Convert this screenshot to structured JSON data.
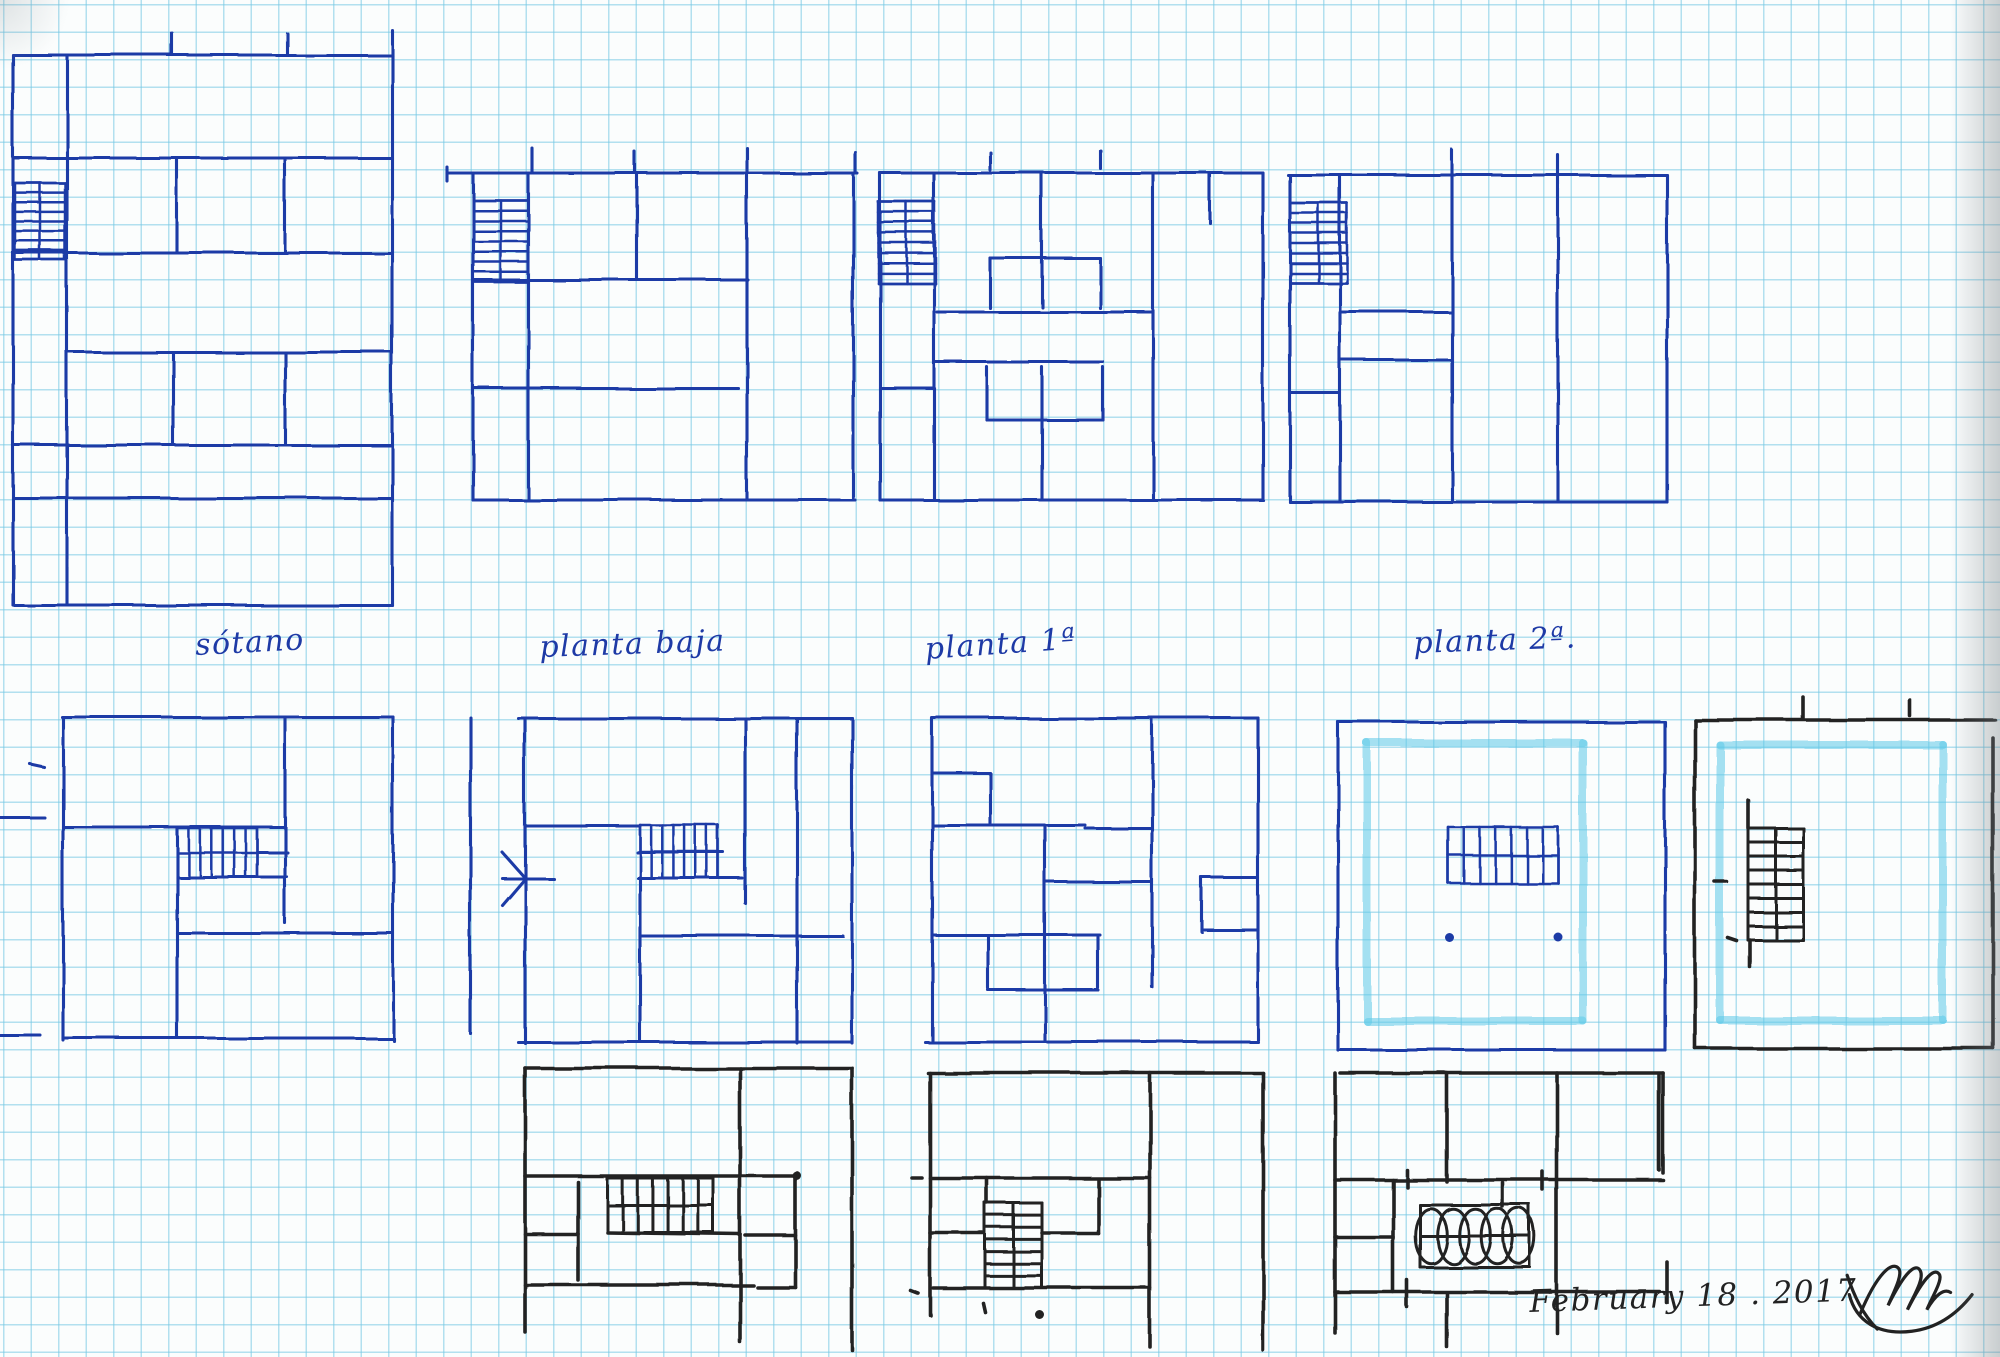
{
  "page": {
    "description": "Hand-drawn architectural floor plan sketches in ink on squared graph paper"
  },
  "colors": {
    "blue": "#1e3aa6",
    "black": "#222222",
    "highlighter": "#5cc9e8",
    "grid": "#76c8e4",
    "paper": "#fbfdfd"
  },
  "labels": [
    {
      "id": "sotano",
      "text": "sótano",
      "x": 196,
      "y": 628,
      "size": 30,
      "ink": "blue",
      "rot": -3
    },
    {
      "id": "planta-baja",
      "text": "planta baja",
      "x": 540,
      "y": 630,
      "size": 30,
      "ink": "blue",
      "rot": -2
    },
    {
      "id": "planta-1",
      "text": "planta 1ª",
      "x": 926,
      "y": 632,
      "size": 30,
      "ink": "blue",
      "rot": -4
    },
    {
      "id": "planta-2",
      "text": "planta 2ª.",
      "x": 1414,
      "y": 626,
      "size": 30,
      "ink": "blue",
      "rot": -2
    },
    {
      "id": "date-note",
      "text": "February 18 . 2017",
      "x": 1530,
      "y": 1284,
      "size": 31,
      "ink": "black",
      "rot": -2
    }
  ],
  "signature": {
    "strokes": [
      "M2,22 C8,40 16,58 30,72",
      "M14,58 C30,20 44,8 50,16 C54,22 44,40 40,50 C56,18 66,10 70,18 C74,26 62,44 58,54 C74,22 84,14 88,22 C90,28 80,44 76,54 C84,40 92,34 98,38",
      "M4,40 C10,64 30,78 62,74 C86,71 104,58 118,40"
    ]
  },
  "plans": [
    {
      "id": "sotano-upper",
      "ink": "blue",
      "lines": [
        [
          13,
          55,
          392,
          55
        ],
        [
          13,
          55,
          13,
          605
        ],
        [
          392,
          55,
          392,
          605
        ],
        [
          13,
          605,
          392,
          605
        ],
        [
          67,
          55,
          67,
          605
        ],
        [
          13,
          158,
          392,
          158
        ],
        [
          13,
          253,
          392,
          253
        ],
        [
          67,
          352,
          392,
          352
        ],
        [
          13,
          445,
          392,
          445
        ],
        [
          13,
          498,
          392,
          498
        ],
        [
          177,
          158,
          177,
          253
        ],
        [
          285,
          158,
          285,
          253
        ],
        [
          173,
          352,
          173,
          443
        ],
        [
          285,
          352,
          285,
          443
        ],
        [
          172,
          33,
          172,
          55
        ],
        [
          287,
          33,
          287,
          55
        ],
        [
          392,
          30,
          392,
          55
        ]
      ],
      "stairs": [
        {
          "x": 15,
          "y": 183,
          "w": 50,
          "h": 77,
          "dir": "h",
          "steps": 9,
          "center": true,
          "border": true
        }
      ],
      "dots": []
    },
    {
      "id": "planta-baja-upper",
      "ink": "blue",
      "lines": [
        [
          447,
          173,
          857,
          173
        ],
        [
          447,
          167,
          447,
          181
        ],
        [
          473,
          173,
          473,
          500
        ],
        [
          528,
          173,
          528,
          500
        ],
        [
          637,
          173,
          637,
          278
        ],
        [
          473,
          280,
          748,
          280
        ],
        [
          747,
          173,
          747,
          500
        ],
        [
          473,
          388,
          738,
          388
        ],
        [
          853,
          173,
          853,
          500
        ],
        [
          473,
          500,
          855,
          500
        ],
        [
          532,
          148,
          532,
          173
        ],
        [
          635,
          152,
          635,
          173
        ],
        [
          747,
          148,
          747,
          173
        ],
        [
          855,
          152,
          855,
          173
        ]
      ],
      "stairs": [
        {
          "x": 473,
          "y": 200,
          "w": 55,
          "h": 82,
          "dir": "h",
          "steps": 9,
          "center": true,
          "border": true
        }
      ],
      "dots": []
    },
    {
      "id": "planta-1-upper",
      "ink": "blue",
      "lines": [
        [
          880,
          173,
          1263,
          173
        ],
        [
          880,
          173,
          880,
          500
        ],
        [
          934,
          173,
          934,
          500
        ],
        [
          1042,
          173,
          1042,
          307
        ],
        [
          990,
          258,
          1100,
          258
        ],
        [
          990,
          258,
          990,
          308
        ],
        [
          1100,
          258,
          1100,
          308
        ],
        [
          937,
          312,
          1153,
          312
        ],
        [
          1153,
          173,
          1153,
          500
        ],
        [
          935,
          362,
          1103,
          362
        ],
        [
          987,
          367,
          987,
          420
        ],
        [
          1103,
          367,
          1103,
          420
        ],
        [
          987,
          420,
          1103,
          420
        ],
        [
          1042,
          367,
          1042,
          500
        ],
        [
          880,
          388,
          934,
          388
        ],
        [
          1263,
          173,
          1263,
          500
        ],
        [
          880,
          500,
          1263,
          500
        ],
        [
          1210,
          173,
          1210,
          223
        ],
        [
          990,
          152,
          990,
          170
        ],
        [
          1100,
          150,
          1100,
          168
        ]
      ],
      "stairs": [
        {
          "x": 878,
          "y": 202,
          "w": 57,
          "h": 81,
          "dir": "h",
          "steps": 9,
          "center": true,
          "border": true
        }
      ],
      "dots": []
    },
    {
      "id": "planta-2-upper",
      "ink": "blue",
      "lines": [
        [
          1288,
          175,
          1667,
          175
        ],
        [
          1290,
          175,
          1290,
          502
        ],
        [
          1340,
          175,
          1340,
          502
        ],
        [
          1452,
          175,
          1452,
          502
        ],
        [
          1340,
          312,
          1452,
          312
        ],
        [
          1340,
          360,
          1452,
          360
        ],
        [
          1290,
          393,
          1340,
          393
        ],
        [
          1558,
          175,
          1558,
          502
        ],
        [
          1667,
          175,
          1667,
          502
        ],
        [
          1290,
          502,
          1667,
          502
        ],
        [
          1452,
          150,
          1452,
          175
        ],
        [
          1558,
          155,
          1558,
          175
        ]
      ],
      "stairs": [
        {
          "x": 1290,
          "y": 203,
          "w": 57,
          "h": 80,
          "dir": "h",
          "steps": 9,
          "center": true,
          "border": true
        }
      ],
      "dots": []
    },
    {
      "id": "sotano-lower",
      "ink": "blue",
      "lines": [
        [
          62,
          717,
          393,
          717
        ],
        [
          63,
          717,
          63,
          1040
        ],
        [
          393,
          717,
          393,
          1040
        ],
        [
          63,
          1038,
          393,
          1038
        ],
        [
          285,
          717,
          285,
          923
        ],
        [
          63,
          827,
          285,
          827
        ],
        [
          177,
          828,
          177,
          1038
        ],
        [
          177,
          933,
          393,
          933
        ],
        [
          257,
          852,
          287,
          852
        ],
        [
          177,
          877,
          287,
          877
        ],
        [
          0,
          818,
          45,
          818
        ],
        [
          0,
          1035,
          40,
          1035
        ],
        [
          30,
          764,
          44,
          767
        ]
      ],
      "stairs": [
        {
          "x": 177,
          "y": 828,
          "w": 80,
          "h": 49,
          "dir": "v",
          "steps": 8,
          "center": true,
          "border": true
        }
      ],
      "dots": []
    },
    {
      "id": "planta-baja-lower",
      "ink": "blue",
      "lines": [
        [
          470,
          717,
          470,
          1033
        ],
        [
          518,
          718,
          852,
          718
        ],
        [
          525,
          718,
          525,
          1043
        ],
        [
          502,
          852,
          525,
          878
        ],
        [
          502,
          905,
          525,
          878
        ],
        [
          502,
          878,
          553,
          878
        ],
        [
          525,
          826,
          640,
          826
        ],
        [
          637,
          852,
          723,
          852
        ],
        [
          638,
          878,
          742,
          878
        ],
        [
          745,
          718,
          745,
          903
        ],
        [
          640,
          878,
          640,
          1040
        ],
        [
          640,
          936,
          843,
          936
        ],
        [
          797,
          718,
          797,
          1043
        ],
        [
          852,
          718,
          852,
          1043
        ],
        [
          518,
          1042,
          852,
          1042
        ]
      ],
      "stairs": [
        {
          "x": 640,
          "y": 825,
          "w": 78,
          "h": 53,
          "dir": "v",
          "steps": 8,
          "center": true,
          "border": true
        }
      ],
      "dots": []
    },
    {
      "id": "planta-1-lower",
      "ink": "blue",
      "lines": [
        [
          933,
          718,
          1258,
          718
        ],
        [
          932,
          718,
          932,
          1040
        ],
        [
          932,
          773,
          990,
          773
        ],
        [
          990,
          773,
          990,
          823
        ],
        [
          932,
          825,
          1085,
          825
        ],
        [
          1085,
          828,
          1150,
          828
        ],
        [
          1045,
          825,
          1045,
          1040
        ],
        [
          1152,
          718,
          1152,
          987
        ],
        [
          1045,
          882,
          1152,
          882
        ],
        [
          1202,
          878,
          1258,
          878
        ],
        [
          1202,
          878,
          1202,
          932
        ],
        [
          1202,
          930,
          1258,
          930
        ],
        [
          932,
          935,
          1100,
          935
        ],
        [
          988,
          937,
          988,
          988
        ],
        [
          1098,
          937,
          1098,
          988
        ],
        [
          988,
          990,
          1098,
          990
        ],
        [
          925,
          1042,
          1258,
          1042
        ],
        [
          1258,
          718,
          1258,
          1040
        ]
      ],
      "stairs": [],
      "dots": []
    },
    {
      "id": "planta-2-lower",
      "ink": "blue",
      "highlight": {
        "x": 1367,
        "y": 743,
        "w": 216,
        "h": 278
      },
      "lines": [
        [
          1338,
          722,
          1665,
          722
        ],
        [
          1338,
          722,
          1338,
          1050
        ],
        [
          1665,
          722,
          1665,
          1050
        ],
        [
          1338,
          1050,
          1665,
          1050
        ]
      ],
      "stairs": [
        {
          "x": 1448,
          "y": 827,
          "w": 110,
          "h": 56,
          "dir": "v",
          "steps": 8,
          "center": true,
          "border": true
        }
      ],
      "dots": [
        [
          1450,
          938
        ],
        [
          1558,
          937
        ]
      ]
    },
    {
      "id": "roof-plan",
      "ink": "black",
      "highlight": {
        "x": 1720,
        "y": 745,
        "w": 223,
        "h": 275
      },
      "lines": [
        [
          1695,
          720,
          1995,
          720
        ],
        [
          1695,
          720,
          1695,
          1048
        ],
        [
          1993,
          738,
          1993,
          1048
        ],
        [
          1695,
          1048,
          1993,
          1048
        ],
        [
          1748,
          800,
          1748,
          828
        ],
        [
          1750,
          940,
          1750,
          967
        ],
        [
          1803,
          697,
          1803,
          718
        ],
        [
          1910,
          700,
          1910,
          716
        ],
        [
          1715,
          882,
          1727,
          882
        ],
        [
          1728,
          938,
          1737,
          941
        ]
      ],
      "stairs": [
        {
          "x": 1748,
          "y": 828,
          "w": 55,
          "h": 112,
          "dir": "h",
          "steps": 9,
          "center": true,
          "border": true
        }
      ],
      "dots": []
    },
    {
      "id": "black-plan-1",
      "ink": "black",
      "lines": [
        [
          525,
          1068,
          852,
          1068
        ],
        [
          525,
          1068,
          525,
          1332
        ],
        [
          740,
          1068,
          740,
          1342
        ],
        [
          852,
          1068,
          852,
          1350
        ],
        [
          525,
          1176,
          797,
          1176
        ],
        [
          795,
          1176,
          795,
          1287
        ],
        [
          578,
          1182,
          578,
          1280
        ],
        [
          607,
          1232,
          740,
          1234
        ],
        [
          525,
          1234,
          578,
          1234
        ],
        [
          745,
          1235,
          795,
          1235
        ],
        [
          525,
          1285,
          753,
          1285
        ],
        [
          757,
          1287,
          795,
          1287
        ]
      ],
      "stairs": [
        {
          "x": 607,
          "y": 1178,
          "w": 106,
          "h": 54,
          "dir": "v",
          "steps": 8,
          "center": true,
          "border": true
        }
      ],
      "dots": [
        [
          797,
          1176
        ]
      ]
    },
    {
      "id": "black-plan-2",
      "ink": "black",
      "lines": [
        [
          928,
          1073,
          1263,
          1073
        ],
        [
          930,
          1073,
          930,
          1315
        ],
        [
          1150,
          1073,
          1150,
          1347
        ],
        [
          1263,
          1073,
          1263,
          1350
        ],
        [
          930,
          1178,
          1150,
          1178
        ],
        [
          912,
          1178,
          922,
          1178
        ],
        [
          987,
          1178,
          987,
          1203
        ],
        [
          1098,
          1180,
          1098,
          1233
        ],
        [
          1042,
          1233,
          1098,
          1233
        ],
        [
          930,
          1233,
          983,
          1233
        ],
        [
          933,
          1288,
          1150,
          1288
        ],
        [
          910,
          1290,
          918,
          1293
        ],
        [
          983,
          1303,
          985,
          1312
        ]
      ],
      "stairs": [
        {
          "x": 985,
          "y": 1203,
          "w": 57,
          "h": 85,
          "dir": "h",
          "steps": 8,
          "center": true,
          "border": true
        }
      ],
      "dots": [
        [
          1040,
          1315
        ]
      ]
    },
    {
      "id": "black-plan-3",
      "ink": "black",
      "lines": [
        [
          1340,
          1073,
          1663,
          1073
        ],
        [
          1335,
          1073,
          1335,
          1333
        ],
        [
          1447,
          1073,
          1447,
          1182
        ],
        [
          1557,
          1073,
          1557,
          1190
        ],
        [
          1663,
          1073,
          1663,
          1173
        ],
        [
          1659,
          1075,
          1659,
          1170
        ],
        [
          1335,
          1180,
          1663,
          1180
        ],
        [
          1393,
          1180,
          1393,
          1292
        ],
        [
          1407,
          1170,
          1407,
          1187
        ],
        [
          1543,
          1172,
          1543,
          1190
        ],
        [
          1503,
          1183,
          1503,
          1207
        ],
        [
          1335,
          1237,
          1393,
          1237
        ],
        [
          1557,
          1190,
          1557,
          1333
        ],
        [
          1335,
          1292,
          1660,
          1292
        ],
        [
          1447,
          1293,
          1447,
          1347
        ],
        [
          1667,
          1262,
          1667,
          1303
        ],
        [
          1407,
          1280,
          1407,
          1307
        ]
      ],
      "stairs": [
        {
          "x": 1420,
          "y": 1205,
          "w": 110,
          "h": 62,
          "dir": "v",
          "steps": 5,
          "center": true,
          "border": true,
          "style": "coil"
        }
      ],
      "dots": []
    }
  ]
}
